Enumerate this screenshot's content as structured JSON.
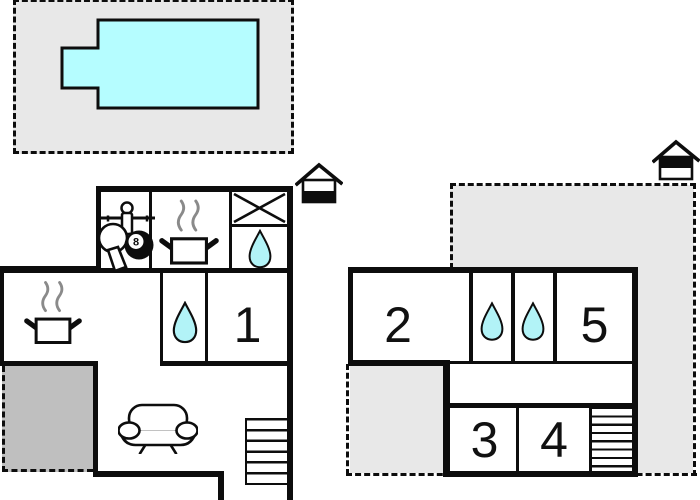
{
  "title": "Holiday home floor plan with swimming pool, ground floor and upper floor",
  "colors": {
    "wall": "#0d0d0d",
    "pool_fill": "#b5fdff",
    "water_drop_fill": "#b2f3f7",
    "terrace_light": "#e8e8e8",
    "terrace_dark": "#bfbfbf",
    "steam": "#8a8a8a",
    "background": "#ffffff"
  },
  "pool_area": {
    "feature": "swimming-pool",
    "surround": "terrace"
  },
  "ground_floor": {
    "level_marker": "house-icon-lower-level-filled",
    "rooms": {
      "games_room": {
        "icons": [
          "table-tennis-paddle",
          "foosball-player",
          "eight-ball"
        ],
        "eight_ball_label": "8"
      },
      "kitchen_top": {
        "icons": [
          "cooking-pot-with-steam"
        ]
      },
      "storage_box": {
        "icons": [
          "crossed-square"
        ]
      },
      "bathroom_top": {
        "icons": [
          "water-drop"
        ]
      },
      "kitchen_living": {
        "icons": [
          "cooking-pot-with-steam"
        ]
      },
      "bathroom_mid": {
        "icons": [
          "water-drop"
        ]
      },
      "bedroom_1": {
        "number": "1"
      },
      "living_room": {
        "icons": [
          "sofa"
        ]
      },
      "stairs": {
        "icons": [
          "staircase"
        ]
      },
      "terrace": {
        "fill": "dark-gray",
        "border": "dashed"
      }
    }
  },
  "upper_floor": {
    "level_marker": "house-icon-upper-level-filled",
    "rooms": {
      "bedroom_2": {
        "number": "2"
      },
      "bathroom_left": {
        "icons": [
          "water-drop"
        ]
      },
      "bathroom_right": {
        "icons": [
          "water-drop"
        ]
      },
      "bedroom_5": {
        "number": "5"
      },
      "hallway": {},
      "bedroom_3": {
        "number": "3"
      },
      "bedroom_4": {
        "number": "4"
      },
      "stairs": {
        "icons": [
          "staircase"
        ]
      },
      "terrace": {
        "fill": "light-gray",
        "border": "dashed"
      }
    }
  }
}
